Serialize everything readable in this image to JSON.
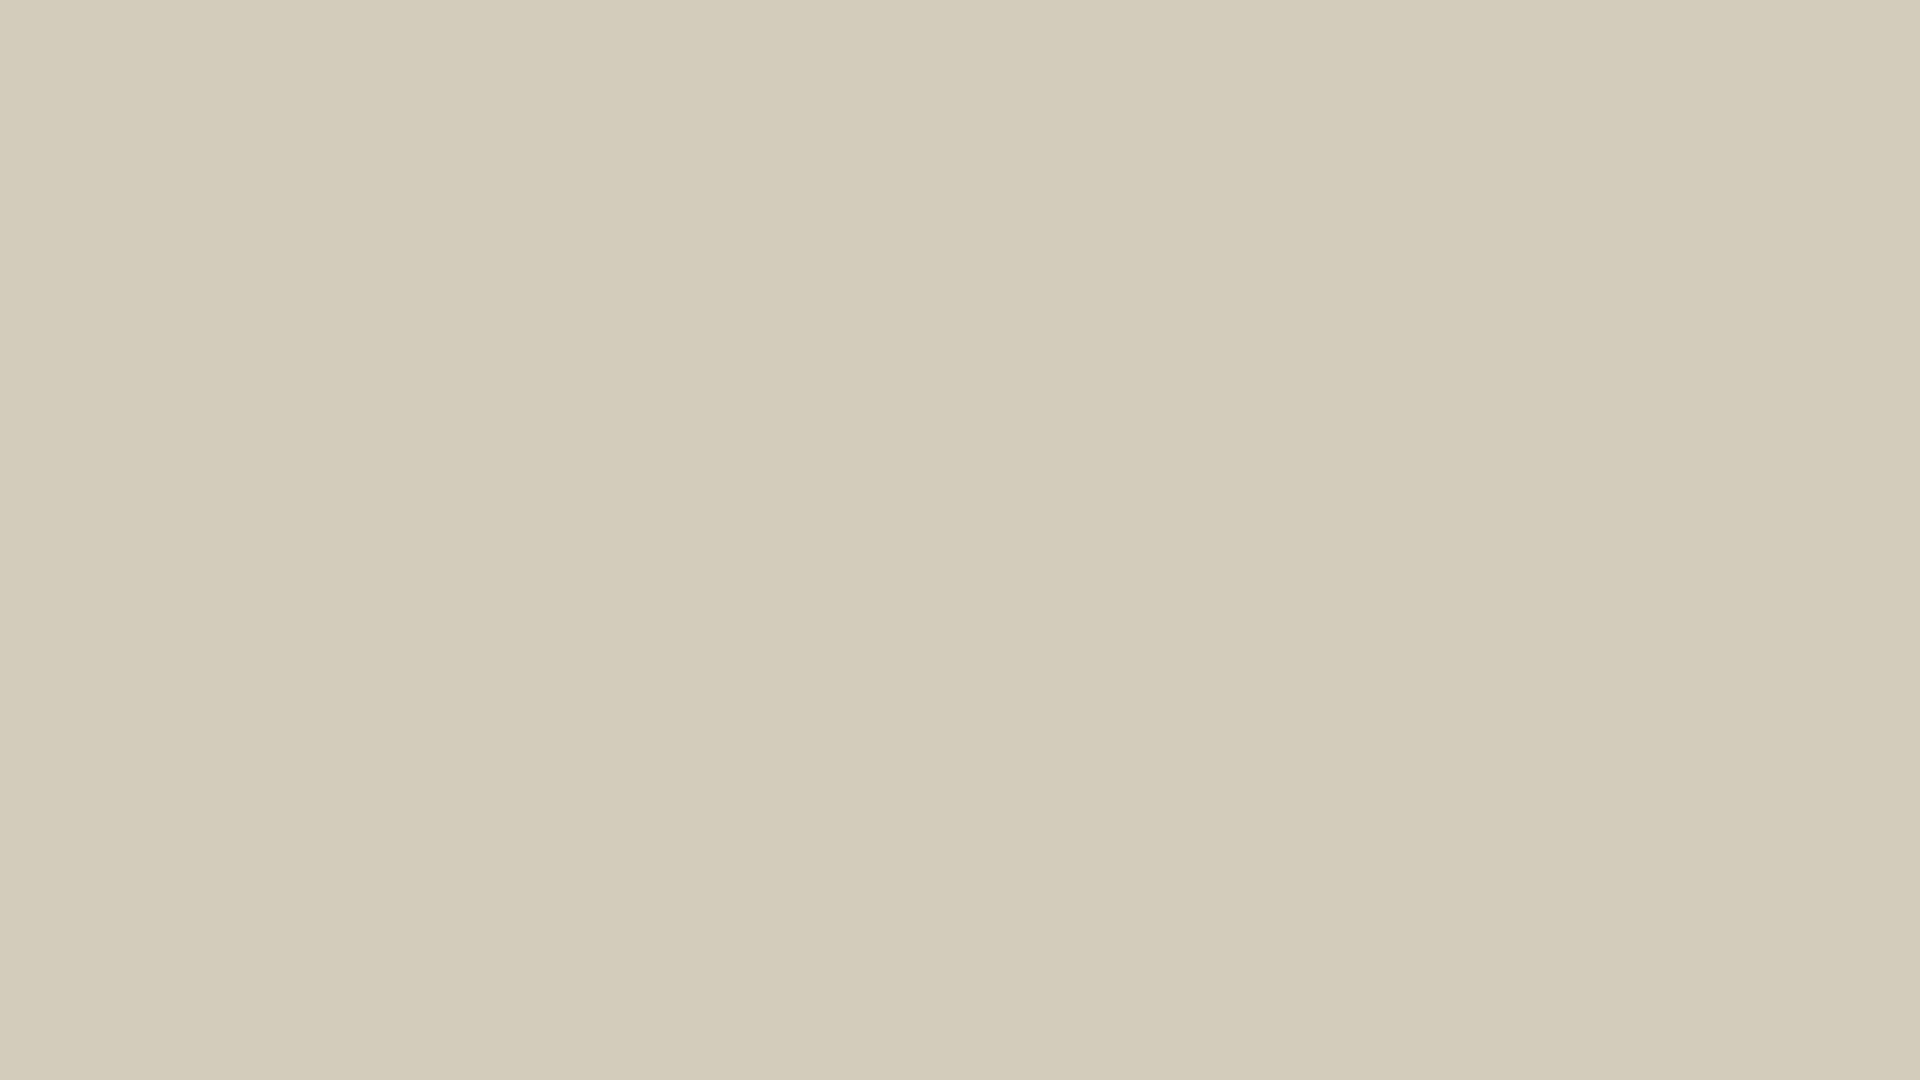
{
  "meta": {
    "kind": "aerial-photograph-with-architectural-render",
    "subject": "new-build villa development composited on aerial photo of semi-desert plot",
    "width": 1920,
    "height": 1080,
    "visible_text": ""
  },
  "palette": {
    "sand_base": "#d3ccbb",
    "sand_light": "#ece7d9",
    "sand_bright": "#f3f0e7",
    "sand_dark": "#b3aa94",
    "sand_olive": "#8d8a68",
    "shrub_dark": "#39442e",
    "shrub_mid": "#4d5b3e",
    "shrub_light": "#74875d",
    "plant_teal": "#8fae88",
    "road_top": "#b7b3aa",
    "road_bottom": "#a5a6a2",
    "road_bottom_light": "#bcbdb8",
    "sidewalk_salmon": "#d7af92",
    "dev_garden": "#51603c",
    "dev_garden_light": "#5d6c46",
    "pool_light_hi": "#cfe3ea",
    "pool_light_lo": "#8fbacd",
    "pool_neighbor_light": "#6fb0d9",
    "pool_neighbor_royal": "#2f6fb5",
    "pergola_white": "#f4f2ea",
    "roof_beige": "#d4ccba",
    "roof_beige2": "#dbd4c3",
    "wall_dark": "#49525c",
    "wall_mid": "#5a636c",
    "wall_deep": "#30373f",
    "internal_road": "#b4b2aa",
    "parking_pave": "#abaaa4",
    "driveway": "#94958f",
    "perimeter_dark": "#454e57",
    "car_silver": "#babcbe",
    "car_gray": "#9fa3a6",
    "car_slate": "#868c91",
    "car_dark": "#383f46",
    "car_black": "#2c3238",
    "car_mid": "#61666b",
    "deck_white": "#eff1eb",
    "patio_white": "#ece8dc",
    "canopy_slate": "#3a424d",
    "canopy_grid": "#cdd2d6",
    "white_line": "#f6f4ee"
  },
  "development": {
    "origin": {
      "x": 250,
      "y": 138
    },
    "angle_deg": 8.6,
    "width": 1520,
    "height": 472,
    "boundary_wall_color": "#f6f4ee",
    "garden_strip": {
      "x": 36,
      "y": 2,
      "w": 1254,
      "h": 82
    },
    "left_margin_garden": {
      "x": 36,
      "y": 2,
      "w": 120,
      "h": 250
    },
    "top_villas": {
      "count": 4,
      "start_x": 156,
      "pitch": 296,
      "roof_w": 260,
      "roof_y": 118,
      "roof_h": 134,
      "pergola_y": 84,
      "pergola_h": 34,
      "pool_x": [
        100,
        396,
        736,
        1040
      ],
      "pool_y": 26,
      "pool_w": 92,
      "pool_h": 52,
      "loungers_per_garden": 2,
      "plants_per_garden": 3
    },
    "lane_cars": [
      {
        "x": 424,
        "y": 150,
        "w": 34,
        "h": 80,
        "color": "#babcbe"
      },
      {
        "x": 720,
        "y": 158,
        "w": 34,
        "h": 80,
        "color": "#9fa3a6"
      },
      {
        "x": 1016,
        "y": 160,
        "w": 34,
        "h": 80,
        "color": "#868c91"
      }
    ],
    "mid_band": {
      "x": 28,
      "y": 252,
      "w": 1262,
      "h": 14
    },
    "internal_road": {
      "x": 24,
      "y": 266,
      "w": 1396,
      "h": 36
    },
    "mid_road_car": {
      "x": 1112,
      "y": 262,
      "w": 88,
      "h": 36,
      "color": "#84888c"
    },
    "bottom_villas": {
      "count": 6,
      "start_x": 40,
      "pitch": 188,
      "y": 300,
      "h": 148
    },
    "right_parking": {
      "x": 1290,
      "y": 96,
      "w": 130,
      "h": 352,
      "cars": [
        {
          "x": 1322,
          "y": 108,
          "w": 36,
          "h": 92,
          "color": "#61666b"
        },
        {
          "x": 1366,
          "y": 116,
          "w": 36,
          "h": 88,
          "color": "#2c3238"
        }
      ]
    },
    "right_lawn": {
      "x": 1420,
      "y": 70,
      "w": 100,
      "h": 232,
      "plants": 3
    },
    "perimeter_path": {
      "x": 0,
      "y": 448,
      "w": 1420,
      "h": 26
    }
  },
  "surroundings": {
    "top_highway": {
      "x": 1345,
      "y": -62,
      "w": 840,
      "h": 118,
      "angle_deg": 7.5,
      "dash_count": 13
    },
    "shrub_band": {
      "count": 48,
      "x1": 60,
      "y1": 58,
      "x2": 1680,
      "y2": 322,
      "spread": 42
    },
    "shrub_clusters": [
      {
        "count": 26,
        "x": 0,
        "y": 0,
        "w": 300,
        "h": 250
      },
      {
        "count": 20,
        "x": 0,
        "y": 250,
        "w": 190,
        "h": 330
      },
      {
        "count": 8,
        "x": 80,
        "y": 690,
        "w": 180,
        "h": 110
      },
      {
        "count": 16,
        "x": 1750,
        "y": 260,
        "w": 170,
        "h": 460
      },
      {
        "count": 26,
        "x": 430,
        "y": 880,
        "w": 680,
        "h": 200
      },
      {
        "count": 20,
        "x": 1470,
        "y": 930,
        "w": 450,
        "h": 150
      }
    ],
    "olive_strip": {
      "x": 168,
      "y": 420,
      "w": 74,
      "h": 300,
      "angle_deg": 9
    },
    "left_track": {
      "x": 58,
      "y": 455,
      "w": 95,
      "h": 290,
      "angle_deg": 11
    },
    "bottom_road": {
      "x": -60,
      "y": 688,
      "w": 2150,
      "h": 168,
      "angle_deg": 5.2,
      "speckles_white": 150,
      "speckles_dark": 28,
      "smudges": 7
    },
    "sidewalk": {
      "x": -60,
      "y": 856,
      "w": 2150,
      "h": 30,
      "angle_deg": 5.2
    },
    "neighbor_lots": {
      "origin": {
        "x": -10,
        "y": 893
      },
      "angle_deg": 6,
      "patio": {
        "x": 0,
        "y": 6,
        "w": 335,
        "h": 56
      },
      "lawn": {
        "x": 0,
        "y": 46,
        "w": 505,
        "h": 190
      },
      "pool1_deck": {
        "x": 38,
        "y": 78,
        "w": 112,
        "h": 110
      },
      "pool1_water": {
        "x": 50,
        "y": 90,
        "w": 88,
        "h": 86
      },
      "hedge": {
        "x": 268,
        "y": 58,
        "w": 34,
        "h": 142
      },
      "pool2_deck": {
        "x": 318,
        "y": 50,
        "w": 152,
        "h": 120
      },
      "pool2_water": {
        "x": 332,
        "y": 62,
        "w": 124,
        "h": 96
      },
      "canopy": {
        "x": 500,
        "y": 40,
        "w": 100,
        "h": 104
      },
      "white_bar": {
        "x": 405,
        "y": 178,
        "w": 100,
        "h": 16
      },
      "patio_trees": 4
    },
    "far_parked_car": {
      "x": 1660,
      "y": 750,
      "w": 38,
      "h": 92,
      "angle_deg": 8,
      "color": "#b4b6b8"
    },
    "sand_patches": {
      "light": 95,
      "dark": 75
    },
    "bright_dune": {
      "x": 360,
      "y": 860,
      "w": 760,
      "h": 230
    }
  }
}
